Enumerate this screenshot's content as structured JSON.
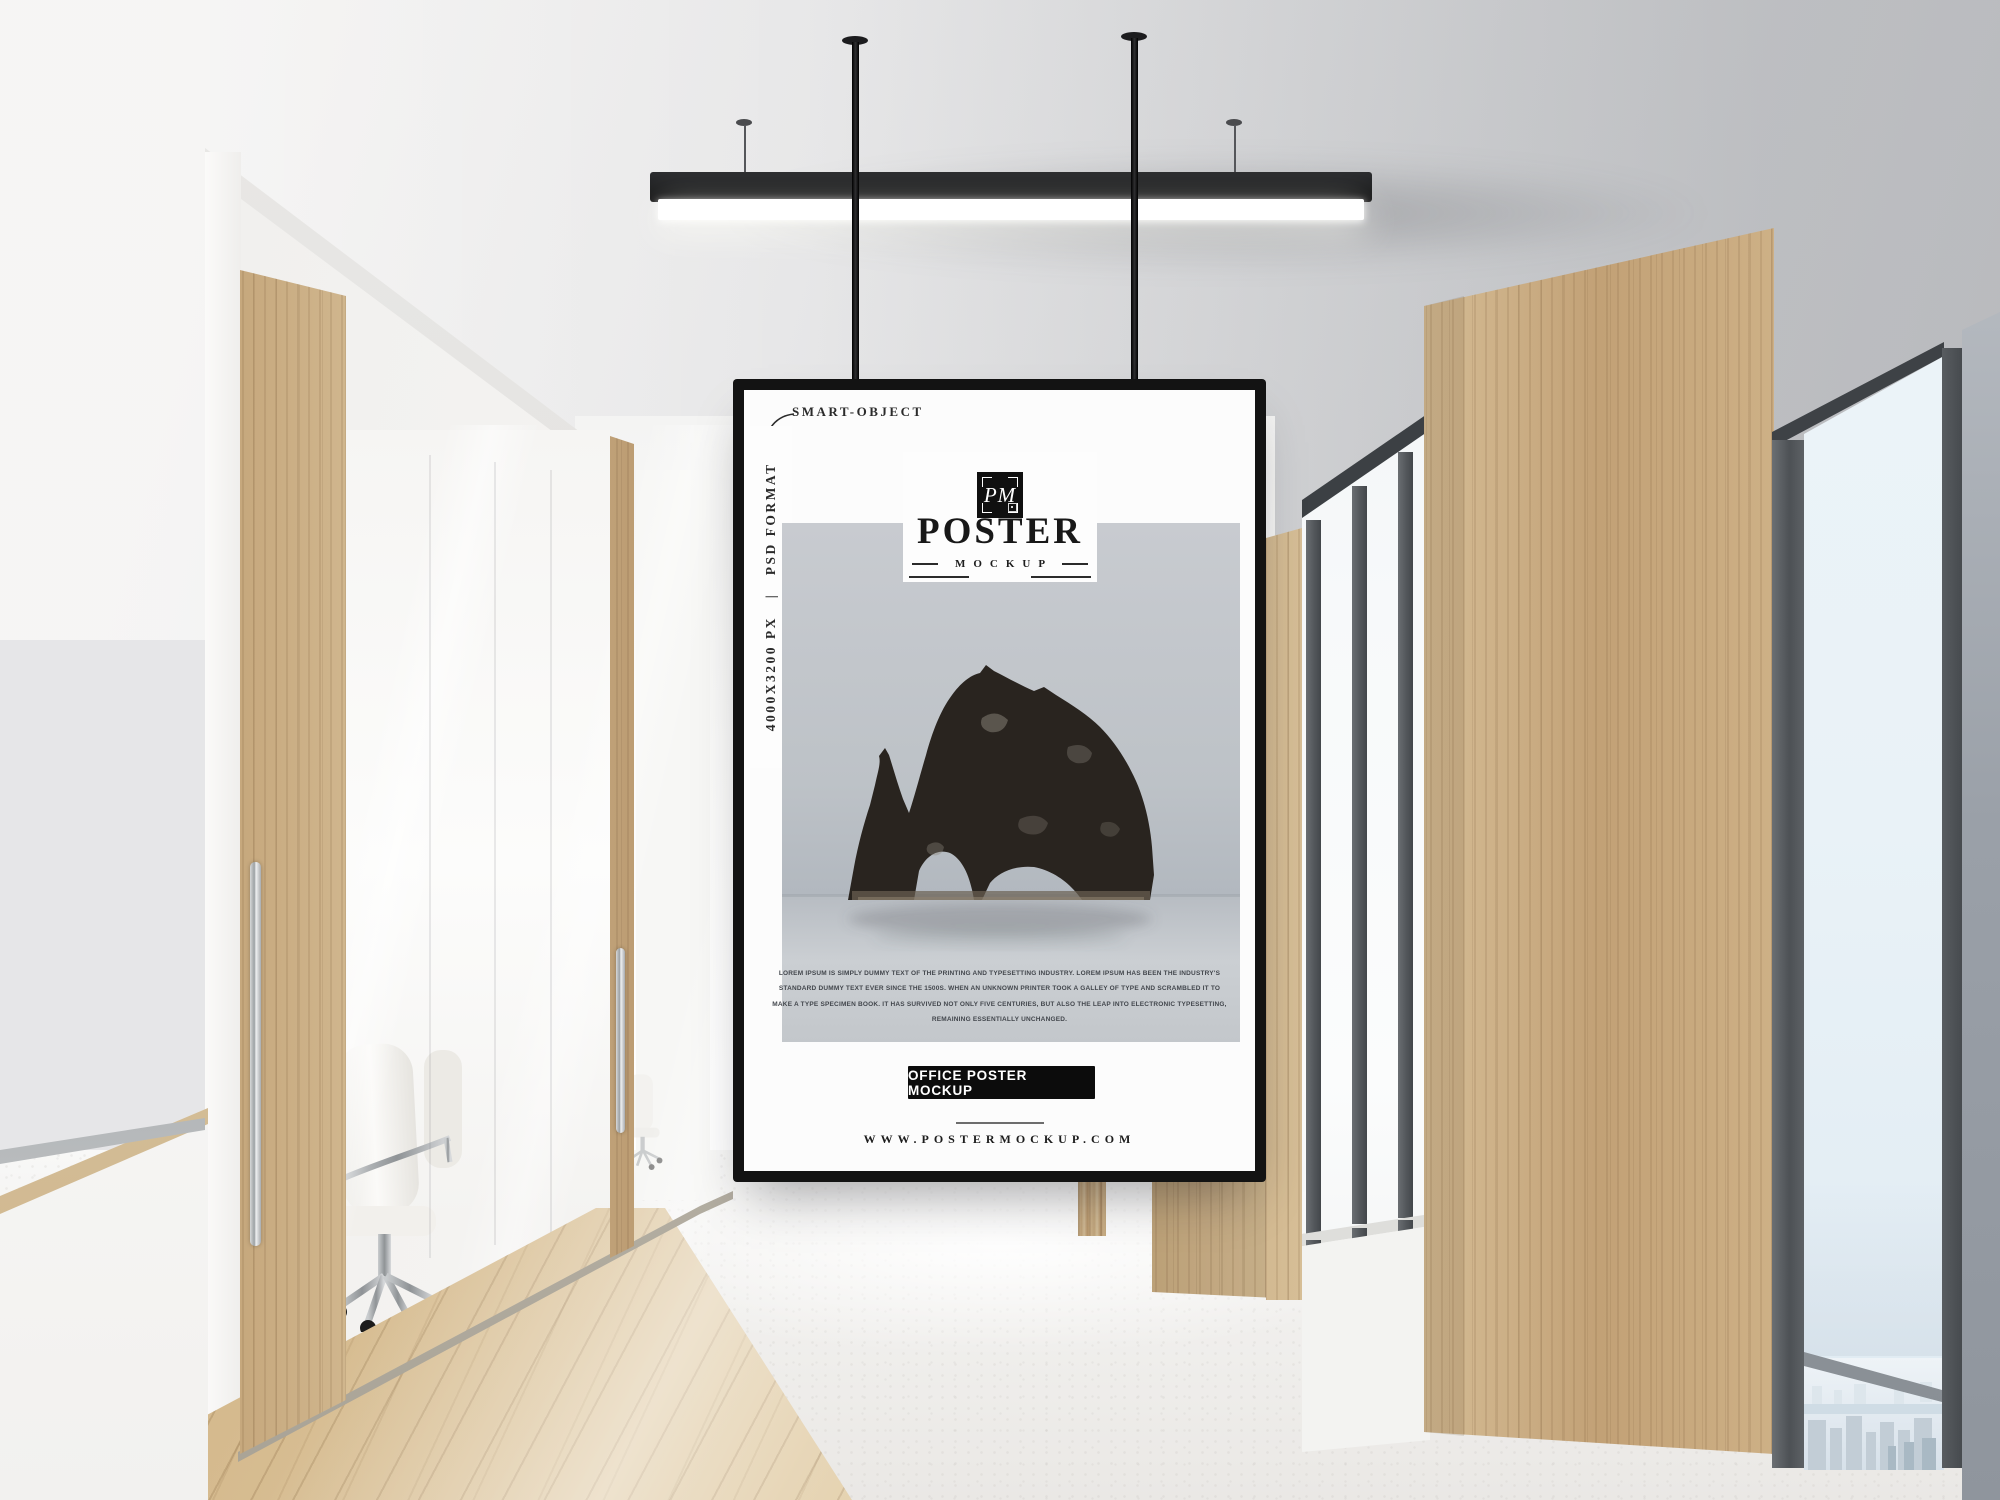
{
  "poster": {
    "annotations": {
      "smart_object": "SMART-OBJECT",
      "side_size": "4000X3200 PX",
      "side_separator": "|",
      "side_format": "PSD FORMAT"
    },
    "logo": {
      "monogram": "PM",
      "title": "POSTER",
      "subtitle": "MOCKUP"
    },
    "body_lines": [
      "LOREM IPSUM IS SIMPLY DUMMY TEXT OF THE PRINTING AND TYPESETTING INDUSTRY. LOREM IPSUM HAS BEEN THE INDUSTRY'S",
      "STANDARD DUMMY TEXT EVER SINCE THE 1500S. WHEN AN UNKNOWN PRINTER TOOK A GALLEY OF TYPE AND SCRAMBLED IT TO",
      "MAKE A TYPE SPECIMEN BOOK. IT HAS SURVIVED NOT ONLY FIVE CENTURIES, BUT ALSO THE LEAP INTO ELECTRONIC TYPESETTING,",
      "REMAINING ESSENTIALLY UNCHANGED."
    ],
    "cta_label": "OFFICE POSTER MOCKUP",
    "website": "WWW.POSTERMOCKUP.COM"
  },
  "colors": {
    "frame_black": "#131313",
    "cta_black": "#0c0c0c",
    "wood_tan": "#cdb088",
    "photo_grey": "#c3c7cc",
    "rock_dark": "#29241f",
    "glass_sky": "#e9f2f7",
    "chrome": "#b9bcbe"
  }
}
